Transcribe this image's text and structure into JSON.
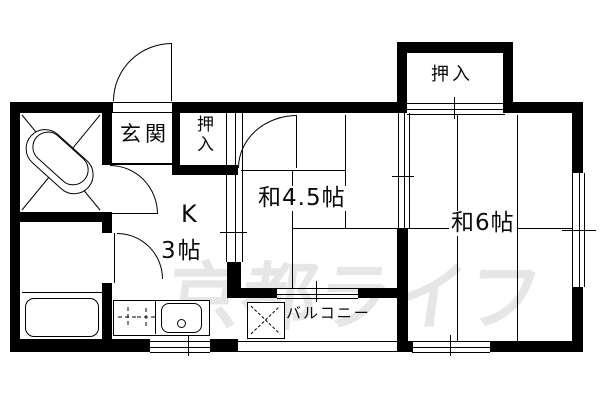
{
  "plan": {
    "type": "apartment-floor-plan",
    "watermark": "京都ライフ",
    "colors": {
      "wall": "#000000",
      "background": "#ffffff",
      "watermark": "#e6e6e6"
    },
    "rooms": {
      "genkan": {
        "label": "玄関"
      },
      "closet_hall": {
        "label": "押入"
      },
      "closet_top": {
        "label": "押入"
      },
      "kitchen": {
        "label": "K",
        "size": "3帖"
      },
      "japanese_room_45": {
        "label": "和4.5帖"
      },
      "japanese_room_6": {
        "label": "和6帖"
      },
      "balcony": {
        "label": "バルコニー"
      }
    },
    "fixtures": [
      "bathtub",
      "gas-stove",
      "kitchen-sink",
      "laundry-pan",
      "water-heater"
    ]
  }
}
